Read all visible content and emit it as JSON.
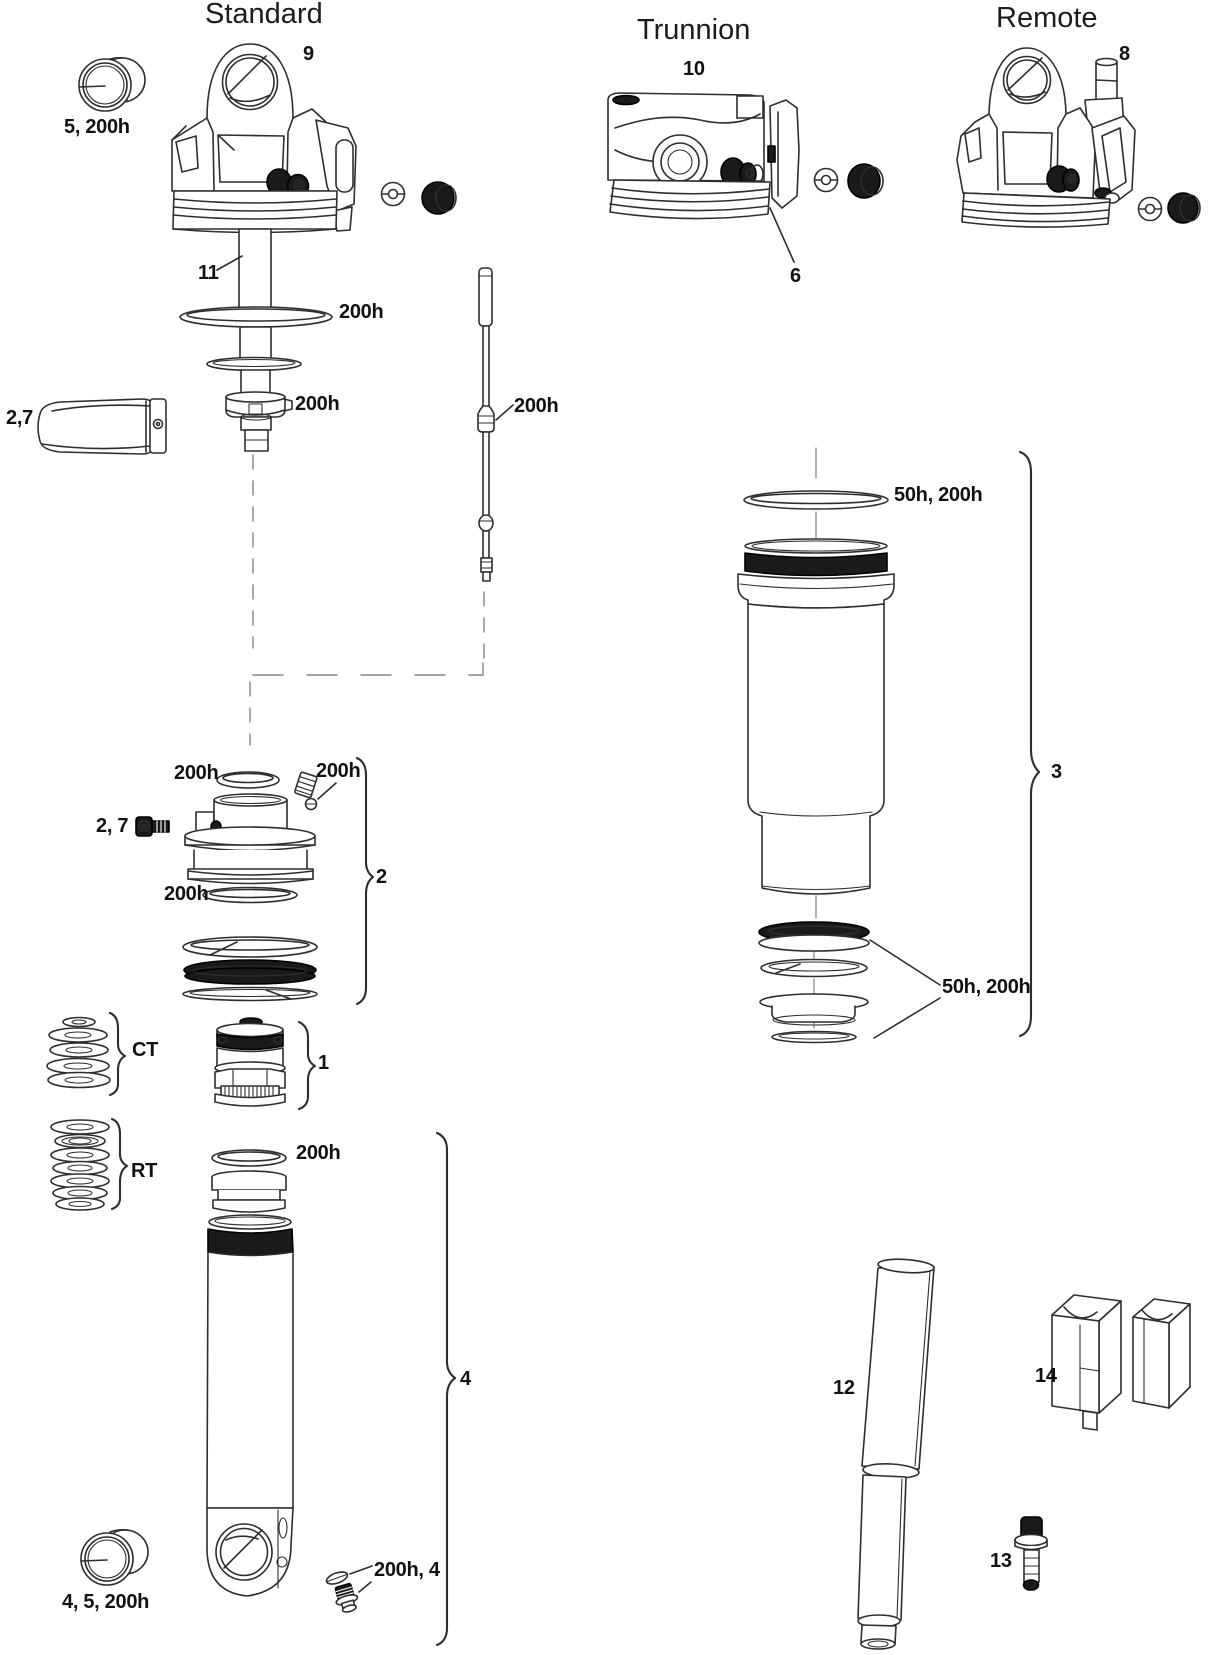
{
  "sections": {
    "standard": {
      "title": "Standard"
    },
    "trunnion": {
      "title": "Trunnion"
    },
    "remote": {
      "title": "Remote"
    }
  },
  "labels": {
    "part9": "9",
    "bushing_top": "5, 200h",
    "shaft11": "11",
    "ring_200h": "200h",
    "bumper_200h": "200h",
    "clamp27": "2,7",
    "rod_200h": "200h",
    "part10": "10",
    "part6": "6",
    "part8": "8",
    "can_oring": "50h, 200h",
    "part3": "3",
    "can_seals": "50h, 200h",
    "piston_oring_top": "200h",
    "setscrew_200h": "200h",
    "screw27": "2, 7",
    "piston_oring_low": "200h",
    "part2": "2",
    "ct": "CT",
    "part1": "1",
    "rt": "RT",
    "body_oring": "200h",
    "part4": "4",
    "part12": "12",
    "part14": "14",
    "part13": "13",
    "bushing_bottom": "4, 5, 200h",
    "plug_200h4": "200h, 4"
  }
}
